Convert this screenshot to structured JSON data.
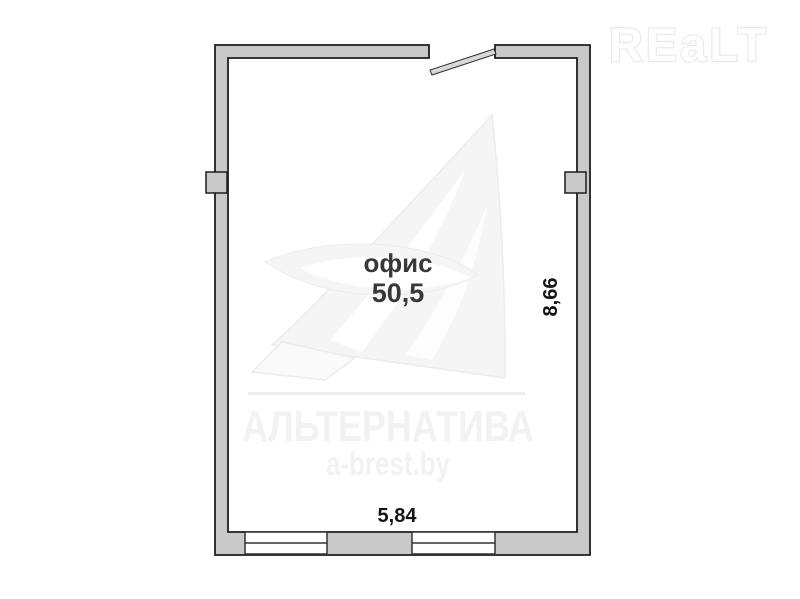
{
  "watermarks": {
    "brand_logo": "REaLT",
    "agency_name": "АЛЬТЕРНАТИВА",
    "agency_site": "a-brest.by"
  },
  "plan": {
    "room": {
      "label": "офис",
      "area": "50,5"
    },
    "dimensions": {
      "bottom_width_m": "5,84",
      "right_height_m": "8,66"
    },
    "features": [
      "door-opening-top",
      "door-leaf",
      "window-bottom-left",
      "window-bottom-right",
      "wall-pilaster-left",
      "wall-pilaster-right"
    ]
  },
  "colors": {
    "background": "#ffffff",
    "wall_fill": "#c9c9c9",
    "wall_outline": "#1e1e1e",
    "window_fill": "#ffffff",
    "room_label_text": "#383838",
    "dimension_text": "#141414",
    "watermark_light": "#f3f3f3"
  }
}
